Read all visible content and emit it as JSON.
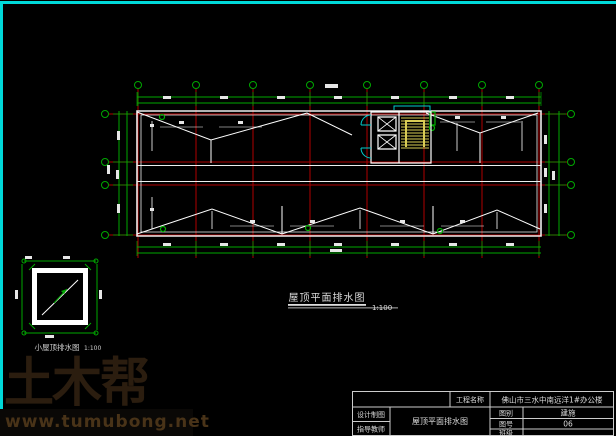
{
  "canvas": {
    "background": "#000000",
    "border_color": "#00d9d9"
  },
  "colors": {
    "axis_red": "#b00000",
    "grid_green": "#00a800",
    "stair_yellow": "#d9cc55",
    "door_cyan": "#00cccc",
    "line_white": "#e6e6e6"
  },
  "main_plan": {
    "title": "屋顶平面排水图",
    "scale": "1:100",
    "grid": {
      "vertical_axes": 8,
      "horizontal_axes": 4
    }
  },
  "detail_plan": {
    "title": "小屋顶排水图",
    "scale": "1:100"
  },
  "watermark": {
    "brand": "土木帮",
    "url": "www.tumubong.net"
  },
  "title_block": {
    "project_label": "工程名称",
    "project_name": "佛山市三水中南远洋1#办公楼",
    "design_draft_label": "设计制图",
    "advisor_label": "指导教师",
    "drawing_title": "屋顶平面排水图",
    "category_label": "图别",
    "category_value": "建施",
    "sheet_no_label": "图号",
    "sheet_no_value": "06",
    "class_label": "班级",
    "class_value": ""
  }
}
